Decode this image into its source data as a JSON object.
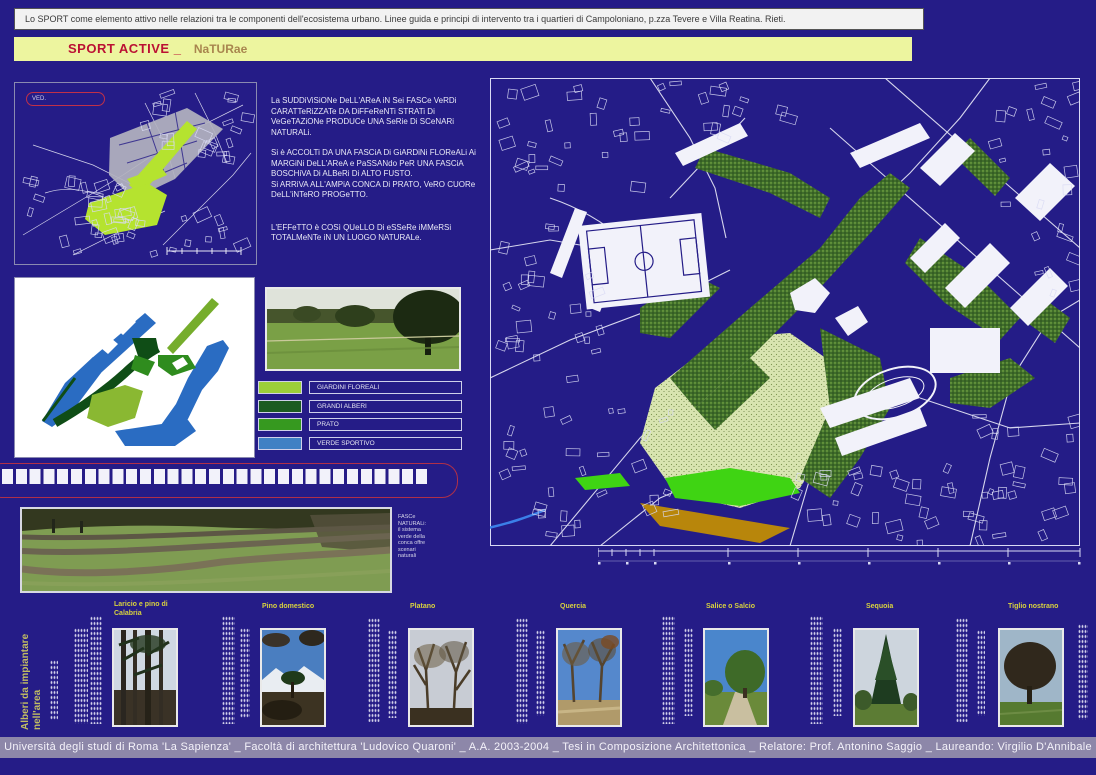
{
  "banner": {
    "text": "Lo SPORT come elemento attivo nelle relazioni tra le componenti dell'ecosistema urbano.  Linee guida e principi di intervento tra i quartieri di Campoloniano, p.zza Tevere e Villa Reatina. Rieti."
  },
  "title": {
    "main": "SPORT ACTIVE _",
    "accent": "NaTURae"
  },
  "overview_map": {
    "label": "VED."
  },
  "description": {
    "p1": "La SUDDiViSiONe DeLL'AReA iN Sei FASCe VeRDi CARATTeRiZZATe DA DiFFeReNTi STRATi Di VeGeTAZiONe PRODUCe UNA SeRie Di SCeNARi NATURALi.",
    "p2": "Si è ACCOLTi DA UNA FASCiA Di GiARDiNi FLOReALi Ai MARGiNi DeLL'AReA e PaSSANdo PeR UNA FASCiA BOSCHiVA Di ALBeRi Di ALTO FUSTO.",
    "p3": "Si ARRiVA ALL'AMPiA CONCA Di PRATO, VeRO CUORe DeLL'iNTeRO PROGeTTO.",
    "p4": "L'EFFeTTO è COSì QUeLLO Di eSSeRe iMMeRSi TOTALMeNTe iN UN LUOGO NATURALe."
  },
  "legend": {
    "items": [
      {
        "label": "GIARDINI FLOREALI",
        "color": "#9ccf3a"
      },
      {
        "label": "GRANDI ALBERI",
        "color": "#1c5b22"
      },
      {
        "label": "PRATO",
        "color": "#36991f"
      },
      {
        "label": "VERDE SPORTIVO",
        "color": "#4080c4"
      }
    ]
  },
  "fasce_note": {
    "lines": [
      "FASCe",
      "NATURALi:",
      "il sistema",
      "verde della",
      "conca offre",
      "scenari",
      "naturali"
    ]
  },
  "trees": {
    "section_label": "Alberi da impiantare nell'area",
    "items": [
      {
        "label": "Laricio e pino di Calabria"
      },
      {
        "label": "Pino domestico"
      },
      {
        "label": "Platano"
      },
      {
        "label": "Quercia"
      },
      {
        "label": "Salice o Salcio"
      },
      {
        "label": "Sequoia"
      },
      {
        "label": "Tiglio nostrano"
      }
    ]
  },
  "footer": {
    "text": "Università degli studi di Roma 'La Sapienza'  _  Facoltà di architettura 'Ludovico Quaroni'  _  A.A. 2003-2004  _  Tesi in Composizione Architettonica  _  Relatore: Prof. Antonino Saggio  _  Laureando: Virgilio D'Annibale"
  },
  "colors": {
    "background": "#251c87",
    "title_bg": "#edf59f",
    "title_red": "#bb1133",
    "title_accent": "#a8854e",
    "tree_label_yellow": "#d8d23e",
    "footer_bg": "#8d87a9",
    "map_highlight_green": "#b5e32f"
  }
}
